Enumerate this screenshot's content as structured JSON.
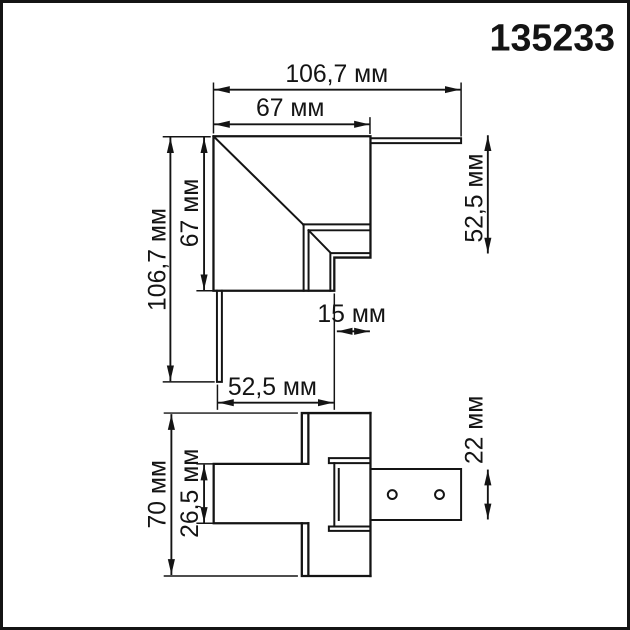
{
  "part_number": "135233",
  "drawing": {
    "type": "technical-dimension-drawing",
    "units": "мм",
    "line_color": "#141414",
    "background": "#ffffff"
  },
  "top_view": {
    "name": "corner-connector-top-view",
    "dims": {
      "total_width": "106,7 мм",
      "body_width": "67 мм",
      "total_height": "106,7 мм",
      "body_height": "67 мм",
      "right_height": "52,5 мм",
      "notch_width": "15 мм",
      "bottom_width": "52,5 мм"
    }
  },
  "side_view": {
    "name": "corner-connector-side-view",
    "dims": {
      "total_height": "70 мм",
      "bar_height": "26,5 мм",
      "track_height": "22 мм"
    },
    "hole_count": 2
  }
}
